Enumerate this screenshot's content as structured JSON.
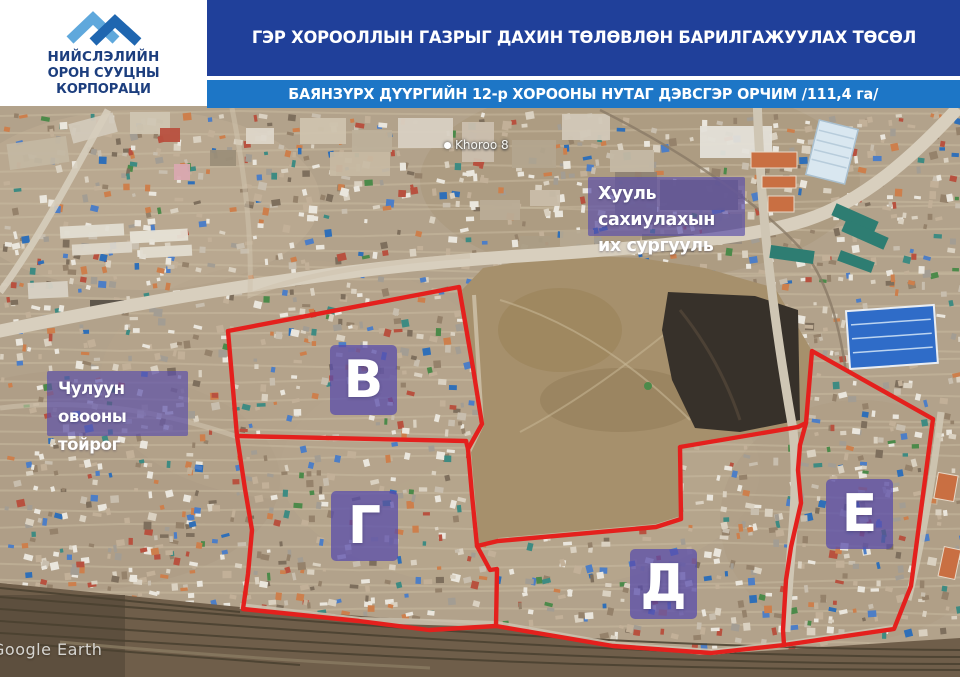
{
  "header": {
    "logo": {
      "line1": "НИЙСЛЭЛИЙН",
      "line2": "ОРОН СУУЦНЫ КОРПОРАЦИ"
    },
    "title_main": "ГЭР ХОРООЛЛЫН ГАЗРЫГ ДАХИН ТӨЛӨВЛӨН БАРИЛГАЖУУЛАХ ТӨСӨЛ",
    "title_sub": "БАЯНЗҮРХ ДҮҮРГИЙН 12-р ХОРООНЫ НУТАГ ДЭВСГЭР ОРЧИМ /111,4 га/",
    "colors": {
      "banner_main": "#20409a",
      "banner_sub": "#1d76c6",
      "logo_text": "#1c3e7e",
      "logo_chevron_light": "#5fa8dc",
      "logo_chevron_dark": "#1f66b0"
    }
  },
  "map": {
    "labels": [
      {
        "id": "law-university",
        "lines": [
          "Хууль сахиулахын",
          "их сургууль"
        ]
      },
      {
        "id": "chuluun-ovoo",
        "lines": [
          "Чулуун овооны",
          "тойрог"
        ]
      }
    ],
    "regions": [
      {
        "letter": "В"
      },
      {
        "letter": "Г"
      },
      {
        "letter": "Д"
      },
      {
        "letter": "Е"
      }
    ],
    "place_label": "Khoroo 8",
    "watermark": "Google Earth",
    "colors": {
      "boundary": "#e4201d",
      "overlay": "rgba(90,78,170,0.68)",
      "overlay_strong": "rgba(88,76,172,0.74)"
    }
  }
}
